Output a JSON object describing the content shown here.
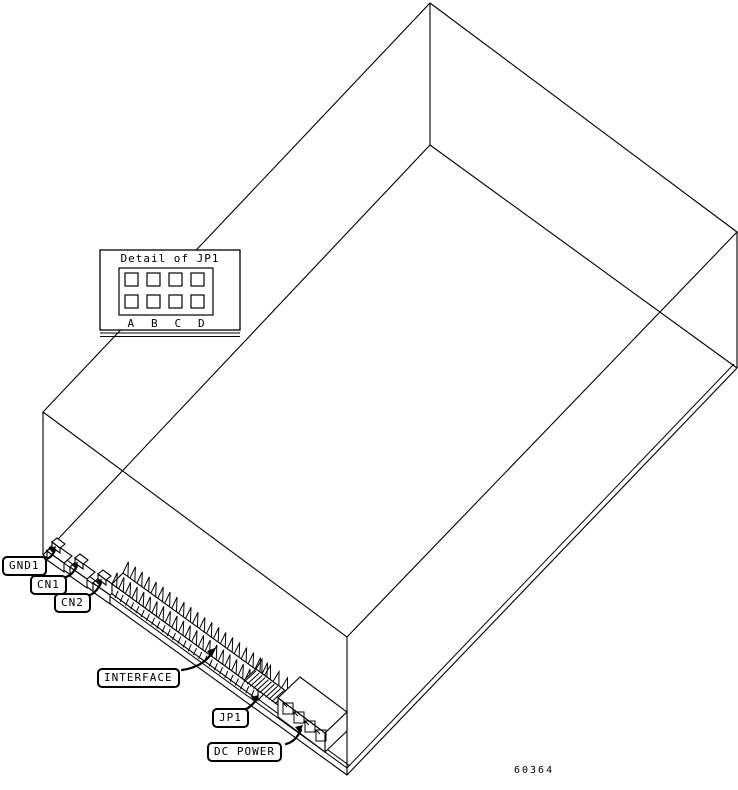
{
  "figure": {
    "part_number": "60364",
    "detail_inset": {
      "title": "Detail of JP1",
      "columns": [
        "A",
        "B",
        "C",
        "D"
      ]
    },
    "callouts": {
      "gnd1": {
        "label": "GND1"
      },
      "cn1": {
        "label": "CN1"
      },
      "cn2": {
        "label": "CN2"
      },
      "interface": {
        "label": "INTERFACE"
      },
      "jp1": {
        "label": "JP1"
      },
      "dc_power": {
        "label": "DC POWER"
      }
    },
    "colors": {
      "line": "#000000",
      "background": "#ffffff"
    }
  }
}
